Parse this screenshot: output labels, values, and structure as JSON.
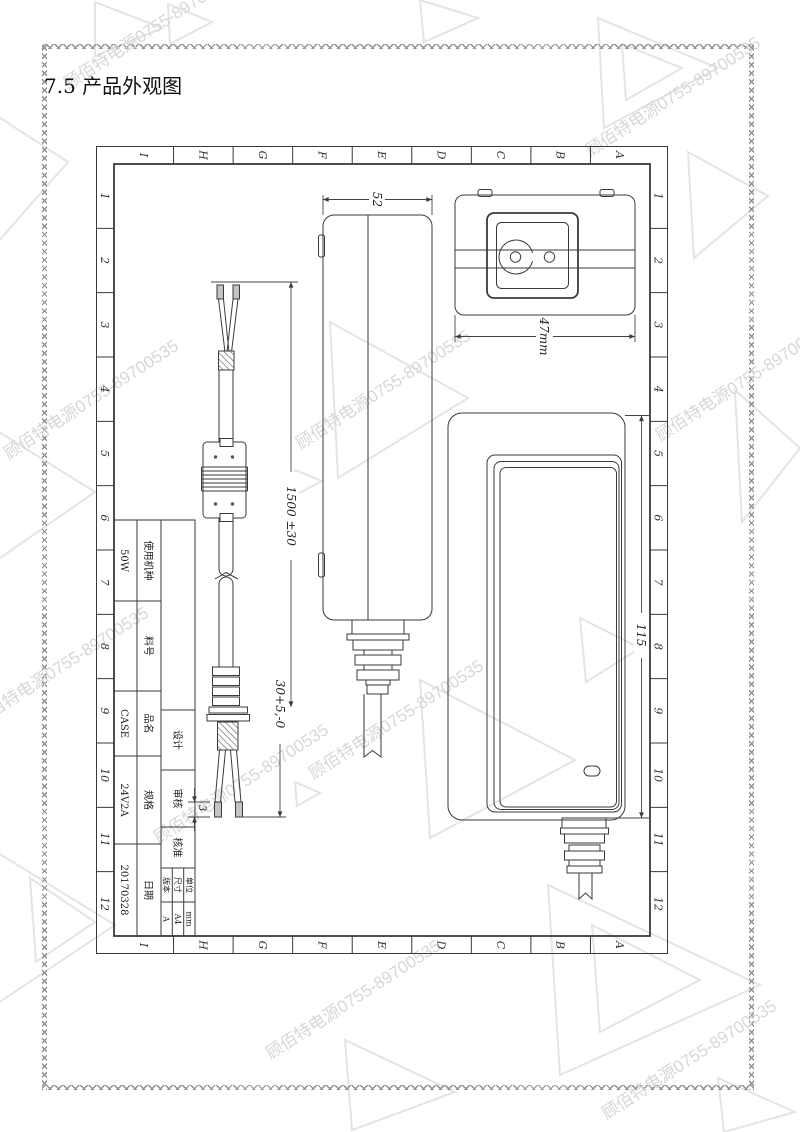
{
  "page": {
    "title": "7.5 产品外观图"
  },
  "watermark": {
    "text": "顾佰特电源0755-89700535"
  },
  "grid": {
    "columns": [
      "1",
      "2",
      "3",
      "4",
      "5",
      "6",
      "7",
      "8",
      "9",
      "10",
      "11",
      "12"
    ],
    "rows": [
      "A",
      "B",
      "C",
      "D",
      "E",
      "F",
      "G",
      "H",
      "I"
    ]
  },
  "dims": {
    "side_width": "52",
    "inlet_width": "47mm",
    "cable_length": "1500 ±30",
    "strip_length": "30+5,-0",
    "tip_length": "3",
    "body_length": "115"
  },
  "title_block": {
    "fields": [
      {
        "label": "使用机种",
        "value": "50W"
      },
      {
        "label": "料号",
        "value": ""
      },
      {
        "label": "品名",
        "value": "CASE"
      },
      {
        "label": "规格",
        "value": "24V2A"
      },
      {
        "label": "日期",
        "value": "20170328"
      }
    ],
    "approvals": [
      {
        "label": "设计"
      },
      {
        "label": "审核"
      },
      {
        "label": "核准"
      }
    ],
    "meta": [
      {
        "label": "单位",
        "value": "mm"
      },
      {
        "label": "尺寸",
        "value": "A4"
      },
      {
        "label": "版本",
        "value": "A"
      }
    ]
  }
}
